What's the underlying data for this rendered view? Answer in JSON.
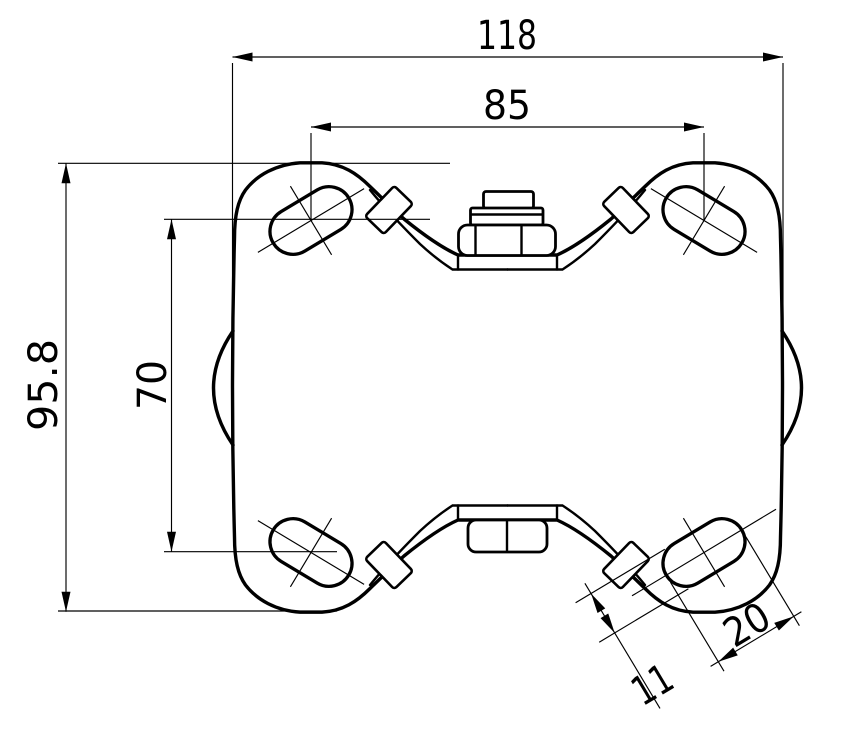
{
  "drawing": {
    "type": "technical-drawing",
    "subject": "caster-top-plate-top-view",
    "background_color": "#ffffff",
    "line_color": "#000000",
    "dimensions": {
      "overall_width": "118",
      "hole_spacing_width": "85",
      "overall_height": "95.8",
      "hole_spacing_height": "70",
      "slot_length": "20",
      "slot_width": "11"
    }
  }
}
